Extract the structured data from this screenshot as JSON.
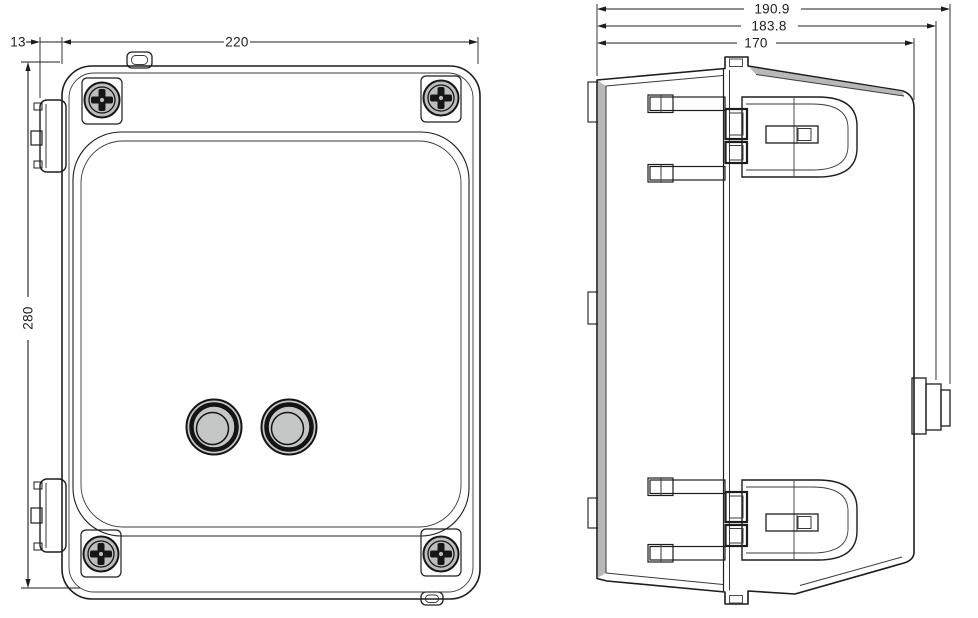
{
  "drawing": {
    "type": "technical-drawing",
    "subject": "wall-mount electrical enclosure, two orthographic views",
    "colors": {
      "body_fill": "#c5c7c6",
      "edge_shade": "#b7b9b8",
      "line": "#1d1d1d",
      "background": "#ffffff"
    },
    "views": {
      "front": {
        "name": "front-view",
        "screw_count": 4,
        "button_count": 2,
        "hinge_count": 2,
        "dimensions": {
          "hinge_offset": "13",
          "width": "220",
          "height": "280"
        }
      },
      "side": {
        "name": "side-view",
        "hinge_count": 2,
        "latch_count": 1,
        "dimensions": {
          "overall_depth": "190.9",
          "hinge_depth": "183.8",
          "body_depth": "170"
        }
      }
    }
  }
}
